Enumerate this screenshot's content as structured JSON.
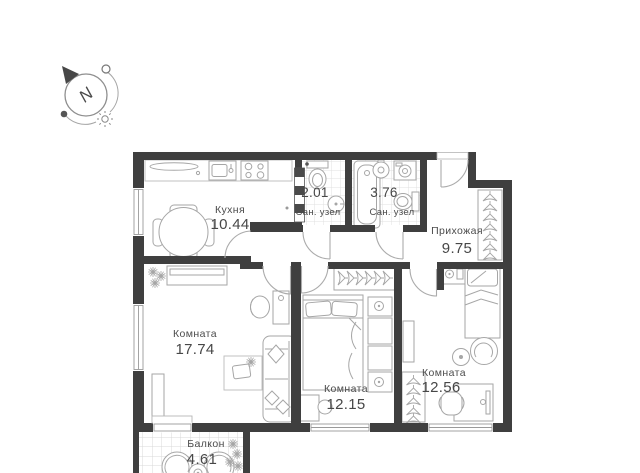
{
  "compass": {
    "letter": "N"
  },
  "rooms": {
    "kitchen": {
      "name": "Кухня",
      "area": "10.44"
    },
    "bathroom_small": {
      "name": "Сан. узел",
      "area": "2.01"
    },
    "bathroom_large": {
      "name": "Сан. узел",
      "area": "3.76"
    },
    "hallway": {
      "name": "Прихожая",
      "area": "9.75"
    },
    "living_room": {
      "name": "Комната",
      "area": "17.74"
    },
    "bedroom_middle": {
      "name": "Комната",
      "area": "12.15"
    },
    "bedroom_right": {
      "name": "Комната",
      "area": "12.56"
    },
    "balcony": {
      "name": "Балкон",
      "area": "4.61"
    }
  },
  "colors": {
    "wall": "#3f3f3f",
    "furniture_line": "#a6a6a6",
    "tile_line": "#dfdfdf",
    "label_text": "#4c4c4c"
  }
}
